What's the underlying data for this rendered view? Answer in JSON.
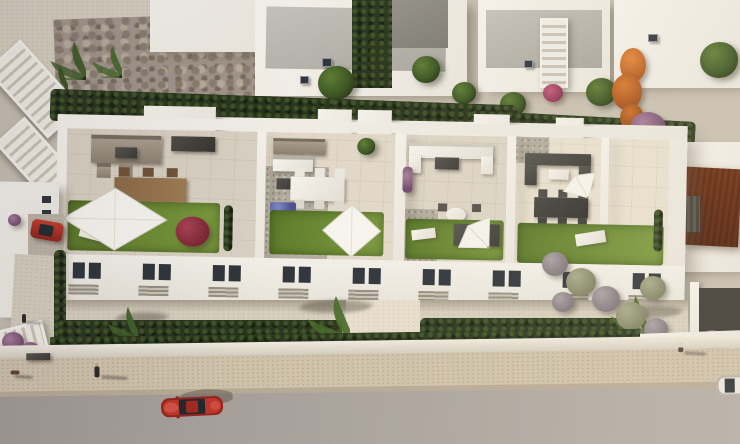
{
  "meta": {
    "type": "aerial-architectural-render",
    "width_px": 740,
    "height_px": 444,
    "description": "Bird's-eye 3D render of a row of four white Mediterranean townhouses with private rooftop solariums (lounge sets, dining tables, parasols, shade sails, artificial lawns), rear gardens with palms, hedges and topiary balls, neighbouring white houses above, a clay-tile-roof neighbour at right, and a street below with a red car, a partially visible white car and pedestrians.",
    "visible_text": "none"
  },
  "palette": {
    "white_walls": "#f0ece4",
    "terrace_tile": "#d8d0c1",
    "gravel_roof": "#b2ac9f",
    "lawn_green": "#6d8a34",
    "hedge_dark": "#2a351e",
    "tree_green": "#3f5a26",
    "orange_tree": "#c96b24",
    "bougainvillea_purple": "#7c5474",
    "clay_roof": "#9a6034",
    "stone_wall": "#a0948a",
    "road_asphalt": "#a59e99",
    "sidewalk_beige": "#cfc2ab",
    "car_red": "#b5322a",
    "car_white": "#e9e7e2",
    "glass_dark": "#2f353b",
    "wood_furniture": "#8a6946"
  },
  "scene": {
    "background_row": {
      "house_count": 5,
      "features": [
        "flat gray roofs",
        "white volumes",
        "two staircases",
        "stone retaining wall",
        "palm cluster",
        "orange autumn tree",
        "dark hedge corridor",
        "pink flower bush"
      ]
    },
    "main_building": {
      "units": 4,
      "terraces": [
        {
          "id": "terrace-1",
          "items": [
            "corner lounge sofa",
            "barbecue counter",
            "timber dining table with 6 chairs",
            "white shade sail",
            "lawn",
            "red flowering shrub",
            "white sun lounger"
          ]
        },
        {
          "id": "terrace-2",
          "items": [
            "wall bench",
            "outdoor kitchen counter",
            "white dining table with 6 chairs",
            "purple flower planters",
            "lawn",
            "white shade sail",
            "potted plant"
          ]
        },
        {
          "id": "terrace-3",
          "items": [
            "white modular lounge",
            "round table",
            "white octagonal parasol",
            "4 dark chairs",
            "lawn",
            "dark garden sofa",
            "white lounger"
          ]
        },
        {
          "id": "terrace-4",
          "items": [
            "dark rattan lounge",
            "tilted white parasol",
            "dark dining table with 6 chairs",
            "lawn",
            "white sun lounger",
            "planter"
          ]
        }
      ],
      "roof_elements": [
        "stairwell bulkheads",
        "gravel roof patches",
        "AC units",
        "white parapets"
      ],
      "facade": {
        "upper_window_pairs": 9,
        "louvre_vents": 9,
        "ground_floor": "recessed gallery with columns and dark doorways"
      }
    },
    "gardens": {
      "palms": 5,
      "hedge_rows": 3,
      "topiary_balls": 7,
      "purple_bushes": 4,
      "left_side": [
        "driveway with parked red car",
        "walkway",
        "stairs",
        "purple shrubs",
        "pedestrian"
      ]
    },
    "right_neighbour": {
      "roof": "clay tiles",
      "bougainvillea": true,
      "dark_courtyard": true,
      "pergola_louvres": true
    },
    "street": {
      "vehicles": [
        {
          "id": "red-car",
          "color_hex": "#b5322a",
          "state": "driving on road"
        },
        {
          "id": "white-car",
          "color_hex": "#e9e7e2",
          "state": "partially visible at right edge"
        }
      ],
      "pedestrians": 3,
      "dog": 1,
      "bench": 1,
      "elements": [
        "boundary wall",
        "thin hedge",
        "beige sidewalk",
        "curb",
        "gray asphalt road"
      ]
    }
  }
}
